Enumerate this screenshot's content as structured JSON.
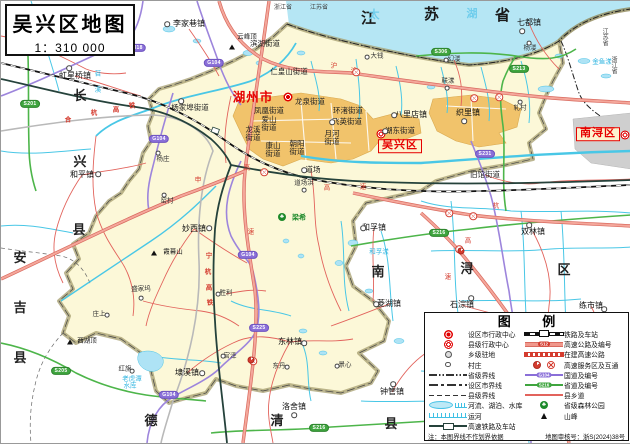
{
  "title": {
    "main": "吴兴区地图",
    "scale": "1：310 000"
  },
  "colors": {
    "region_fill": "#fcf8d8",
    "lake": "#b5e6f4",
    "urban": "#f1c36b",
    "nanxun_urban": "#cfcfcf",
    "boundary_band": "#a59d6e",
    "expressway": "#f0988c",
    "national_road": "#8a6fd8",
    "provincial_road": "#3fa53f",
    "county_road": "#e2635c",
    "hsr": "#25423b",
    "accent_red": "#e60000",
    "water_line": "#49c3e6"
  },
  "map": {
    "province_chars": [
      {
        "t": "江",
        "x": 368,
        "y": 18
      },
      {
        "t": "苏",
        "x": 431,
        "y": 14
      },
      {
        "t": "省",
        "x": 502,
        "y": 15
      }
    ],
    "lake_chars": [
      {
        "t": "太",
        "x": 374,
        "y": 15
      },
      {
        "t": "湖",
        "x": 472,
        "y": 14
      }
    ],
    "county_chars": [
      {
        "t": "长",
        "x": 79,
        "y": 95
      },
      {
        "t": "兴",
        "x": 79,
        "y": 161
      },
      {
        "t": "县",
        "x": 78,
        "y": 229
      },
      {
        "t": "安",
        "x": 19,
        "y": 257
      },
      {
        "t": "吉",
        "x": 19,
        "y": 307
      },
      {
        "t": "县",
        "x": 19,
        "y": 357
      },
      {
        "t": "德",
        "x": 150,
        "y": 420
      },
      {
        "t": "清",
        "x": 276,
        "y": 420
      },
      {
        "t": "县",
        "x": 390,
        "y": 423
      },
      {
        "t": "南",
        "x": 377,
        "y": 271
      },
      {
        "t": "浔",
        "x": 466,
        "y": 268
      },
      {
        "t": "区",
        "x": 563,
        "y": 269
      }
    ],
    "border_small": [
      {
        "t": "浙江省",
        "x": 282,
        "y": 7,
        "v": false
      },
      {
        "t": "江苏省",
        "x": 318,
        "y": 7,
        "v": false
      },
      {
        "t": "江苏省",
        "x": 603,
        "y": 36,
        "v": true
      },
      {
        "t": "浙江省",
        "x": 612,
        "y": 64,
        "v": true
      }
    ],
    "city": {
      "t": "湖州市",
      "x": 252,
      "y": 97,
      "sym": [
        287,
        96
      ]
    },
    "district_boxes": [
      {
        "t": "吴兴区",
        "x": 399,
        "y": 145,
        "sym": [
          380,
          133
        ]
      },
      {
        "t": "南浔区",
        "x": 597,
        "y": 133,
        "sym": [
          624,
          134
        ]
      }
    ],
    "towns": [
      {
        "t": "滨湖街道",
        "x": 264,
        "y": 43,
        "cls": "street"
      },
      {
        "t": "仁皇山街道",
        "x": 288,
        "y": 71,
        "cls": "street"
      },
      {
        "t": "龙泉街道",
        "x": 309,
        "y": 101,
        "cls": "street"
      },
      {
        "t": "凤凰街道",
        "x": 268,
        "y": 110,
        "cls": "street"
      },
      {
        "t": "环渚街道",
        "x": 347,
        "y": 110,
        "cls": "street"
      },
      {
        "t": "飞英街道",
        "x": 346,
        "y": 121,
        "cls": "street",
        "dot": [
          331,
          121
        ]
      },
      {
        "t": "湖东街道",
        "x": 399,
        "y": 130,
        "cls": "street",
        "dot": [
          384,
          130
        ]
      },
      {
        "t": "爱山街道",
        "x": 268,
        "y": 123,
        "cls": "street",
        "lines": [
          "爱山",
          "街道"
        ]
      },
      {
        "t": "龙溪街道",
        "x": 252,
        "y": 133,
        "cls": "street",
        "lines": [
          "龙溪",
          "街道"
        ]
      },
      {
        "t": "月河街道",
        "x": 331,
        "y": 137,
        "cls": "street",
        "lines": [
          "月河",
          "街道"
        ]
      },
      {
        "t": "康山街道",
        "x": 272,
        "y": 149,
        "cls": "street",
        "lines": [
          "康山",
          "街道"
        ]
      },
      {
        "t": "朝阳街道",
        "x": 296,
        "y": 147,
        "cls": "street",
        "lines": [
          "朝阳",
          "街道"
        ]
      },
      {
        "t": "道场",
        "x": 312,
        "y": 169,
        "cls": "street",
        "dot": [
          303,
          169
        ]
      },
      {
        "t": "杨家埠街道",
        "x": 189,
        "y": 107,
        "cls": "street",
        "dot": [
          180,
          100
        ]
      },
      {
        "t": "旧馆街道",
        "x": 484,
        "y": 174,
        "cls": "street"
      },
      {
        "t": "李家巷镇",
        "x": 188,
        "y": 23,
        "cls": "town",
        "dot": [
          166,
          23
        ]
      },
      {
        "t": "虹星桥镇",
        "x": 74,
        "y": 75,
        "cls": "town",
        "dot": [
          68,
          67
        ]
      },
      {
        "t": "和平镇",
        "x": 81,
        "y": 174,
        "cls": "town",
        "dot": [
          97,
          173
        ]
      },
      {
        "t": "妙西镇",
        "x": 193,
        "y": 228,
        "cls": "town",
        "dot": [
          208,
          227
        ]
      },
      {
        "t": "和孚镇",
        "x": 373,
        "y": 227,
        "cls": "town",
        "dot": [
          362,
          227
        ]
      },
      {
        "t": "双林镇",
        "x": 532,
        "y": 231,
        "cls": "town",
        "dot": [
          528,
          224
        ]
      },
      {
        "t": "菱湖镇",
        "x": 388,
        "y": 303,
        "cls": "town",
        "dot": [
          375,
          303
        ]
      },
      {
        "t": "石淙镇",
        "x": 461,
        "y": 304,
        "cls": "town",
        "dot": [
          470,
          297
        ]
      },
      {
        "t": "练市镇",
        "x": 590,
        "y": 305,
        "cls": "town",
        "dot": [
          603,
          308
        ]
      },
      {
        "t": "钟管镇",
        "x": 391,
        "y": 391,
        "cls": "town",
        "dot": [
          392,
          383
        ]
      },
      {
        "t": "东林镇",
        "x": 289,
        "y": 341,
        "cls": "town",
        "dot": [
          303,
          342
        ]
      },
      {
        "t": "洛舍镇",
        "x": 293,
        "y": 406,
        "cls": "town",
        "dot": [
          293,
          414
        ]
      },
      {
        "t": "埭溪镇",
        "x": 186,
        "y": 372,
        "cls": "town",
        "dot": [
          201,
          372
        ]
      },
      {
        "t": "七都镇",
        "x": 528,
        "y": 22,
        "cls": "town",
        "dot": [
          521,
          30
        ]
      },
      {
        "t": "八里店镇",
        "x": 410,
        "y": 114,
        "cls": "town",
        "dot": [
          393,
          114
        ]
      },
      {
        "t": "织里镇",
        "x": 467,
        "y": 112,
        "cls": "town",
        "dot": [
          463,
          120
        ]
      },
      {
        "t": "大钱",
        "x": 376,
        "y": 56,
        "cls": "village",
        "dot": [
          366,
          56
        ]
      },
      {
        "t": "幻溇",
        "x": 453,
        "y": 59,
        "cls": "village",
        "dot": [
          445,
          59
        ]
      },
      {
        "t": "联漾",
        "x": 447,
        "y": 81,
        "cls": "village",
        "dot": [
          446,
          87
        ]
      },
      {
        "t": "杨溇",
        "x": 529,
        "y": 48,
        "cls": "village",
        "dot": [
          528,
          42
        ]
      },
      {
        "t": "轧村",
        "x": 519,
        "y": 108,
        "cls": "village",
        "dot": [
          519,
          101
        ]
      },
      {
        "t": "杨庄",
        "x": 162,
        "y": 159,
        "cls": "village",
        "dot": [
          157,
          152
        ]
      },
      {
        "t": "窑村",
        "x": 166,
        "y": 201,
        "cls": "village",
        "dot": [
          163,
          194
        ]
      },
      {
        "t": "盛家坞",
        "x": 140,
        "y": 289,
        "cls": "village",
        "dot": [
          140,
          297
        ]
      },
      {
        "t": "庄上",
        "x": 98,
        "y": 314,
        "cls": "village",
        "dot": [
          106,
          314
        ]
      },
      {
        "t": "红旗",
        "x": 124,
        "y": 369,
        "cls": "village",
        "dot": [
          131,
          370
        ]
      },
      {
        "t": "胜利",
        "x": 225,
        "y": 293,
        "cls": "village",
        "dot": [
          217,
          293
        ]
      },
      {
        "t": "官泽",
        "x": 229,
        "y": 356,
        "cls": "village",
        "dot": [
          222,
          355
        ]
      },
      {
        "t": "东丹",
        "x": 278,
        "y": 366,
        "cls": "village",
        "dot": [
          286,
          366
        ]
      },
      {
        "t": "景心",
        "x": 344,
        "y": 365,
        "cls": "village",
        "dot": [
          336,
          365
        ]
      },
      {
        "t": "道场浜",
        "x": 303,
        "y": 183,
        "cls": "village",
        "dot": [
          303,
          189
        ]
      }
    ],
    "water_labels": [
      {
        "t": "老虎潭",
        "x": 131,
        "y": 379
      },
      {
        "t": "水库",
        "x": 129,
        "y": 386
      },
      {
        "t": "和孚漾",
        "x": 378,
        "y": 252
      },
      {
        "t": "金鱼漾",
        "x": 601,
        "y": 62
      },
      {
        "t": "苕",
        "x": 97,
        "y": 74
      },
      {
        "t": "溪",
        "x": 97,
        "y": 90
      }
    ],
    "rail_chars": [
      {
        "t": "合",
        "x": 67,
        "y": 120
      },
      {
        "t": "杭",
        "x": 93,
        "y": 113
      },
      {
        "t": "高",
        "x": 115,
        "y": 110
      },
      {
        "t": "铁",
        "x": 131,
        "y": 106
      },
      {
        "t": "宁",
        "x": 208,
        "y": 256
      },
      {
        "t": "杭",
        "x": 207,
        "y": 272
      },
      {
        "t": "高",
        "x": 208,
        "y": 288
      },
      {
        "t": "铁",
        "x": 209,
        "y": 303
      }
    ],
    "highway_chars": [
      {
        "t": "沪",
        "x": 333,
        "y": 66
      },
      {
        "t": "渝",
        "x": 353,
        "y": 71
      },
      {
        "t": "申",
        "x": 197,
        "y": 180
      },
      {
        "t": "高",
        "x": 246,
        "y": 168
      },
      {
        "t": "速",
        "x": 250,
        "y": 232
      },
      {
        "t": "高",
        "x": 326,
        "y": 188
      },
      {
        "t": "速",
        "x": 362,
        "y": 187
      },
      {
        "t": "杭",
        "x": 495,
        "y": 206
      },
      {
        "t": "高",
        "x": 467,
        "y": 241
      },
      {
        "t": "速",
        "x": 447,
        "y": 277
      }
    ],
    "badges": [
      {
        "t": "G318",
        "x": 135,
        "y": 47,
        "c": "p"
      },
      {
        "t": "G104",
        "x": 213,
        "y": 62,
        "c": "p"
      },
      {
        "t": "G104",
        "x": 158,
        "y": 138,
        "c": "p"
      },
      {
        "t": "G104",
        "x": 247,
        "y": 254,
        "c": "p"
      },
      {
        "t": "S225",
        "x": 258,
        "y": 327,
        "c": "p"
      },
      {
        "t": "G104",
        "x": 168,
        "y": 394,
        "c": "p"
      },
      {
        "t": "S231",
        "x": 484,
        "y": 153,
        "c": "p"
      },
      {
        "t": "S306",
        "x": 440,
        "y": 51,
        "c": "g"
      },
      {
        "t": "S213",
        "x": 518,
        "y": 68,
        "c": "g"
      },
      {
        "t": "S216",
        "x": 438,
        "y": 232,
        "c": "g"
      },
      {
        "t": "S216",
        "x": 318,
        "y": 427,
        "c": "g"
      },
      {
        "t": "S205",
        "x": 60,
        "y": 370,
        "c": "g"
      },
      {
        "t": "S201",
        "x": 29,
        "y": 103,
        "c": "g"
      }
    ],
    "peaks": [
      {
        "t": "云峰顶",
        "x": 246,
        "y": 37,
        "tri": [
          231,
          46
        ]
      },
      {
        "t": "霞幕山",
        "x": 172,
        "y": 252,
        "tri": [
          153,
          252
        ]
      },
      {
        "t": "西湖顶",
        "x": 86,
        "y": 341,
        "tri": [
          69,
          341
        ]
      }
    ],
    "forest": {
      "t": "梁希",
      "x": 298,
      "y": 217,
      "sym": [
        281,
        216
      ]
    },
    "interchanges": [
      [
        355,
        71
      ],
      [
        473,
        97
      ],
      [
        498,
        96
      ],
      [
        448,
        212
      ],
      [
        472,
        215
      ],
      [
        458,
        248
      ],
      [
        263,
        171
      ],
      [
        252,
        360
      ]
    ],
    "services": [
      [
        250,
        359
      ],
      [
        460,
        250
      ]
    ]
  },
  "legend": {
    "title": "图  例",
    "rows_left": [
      {
        "sym": "city-center",
        "label": "设区市行政中心"
      },
      {
        "sym": "county-center",
        "label": "县级行政中心"
      },
      {
        "sym": "township-dot",
        "label": "乡级驻地"
      },
      {
        "sym": "village-dot",
        "label": "村庄"
      },
      {
        "sym": "province-line",
        "label": "省级界线"
      },
      {
        "sym": "city-line",
        "label": "设区市界线"
      },
      {
        "sym": "county-line",
        "label": "县级界线"
      },
      {
        "sym": "water",
        "label": "河流、湖泊、水库"
      },
      {
        "sym": "canal",
        "label": "运河"
      },
      {
        "sym": "hsr",
        "label": "高速铁路及车站"
      }
    ],
    "rows_right": [
      {
        "sym": "rail",
        "label": "铁路及车站"
      },
      {
        "sym": "expressway",
        "label": "高速公路及编号",
        "badge": "S12"
      },
      {
        "sym": "construction",
        "label": "在建高速公路"
      },
      {
        "sym": "service",
        "label": "高速服务区及互通"
      },
      {
        "sym": "national-road",
        "label": "国道及编号",
        "badge": "G104"
      },
      {
        "sym": "provincial-road",
        "label": "省道及编号",
        "badge": "S216"
      },
      {
        "sym": "county-road",
        "label": "县乡道"
      },
      {
        "sym": "forest-park",
        "label": "省级森林公园"
      },
      {
        "sym": "peak",
        "label": "山峰"
      }
    ],
    "note": "注：本图界线不作划界依据",
    "review": "地图审核号：浙S(2024)38号"
  }
}
